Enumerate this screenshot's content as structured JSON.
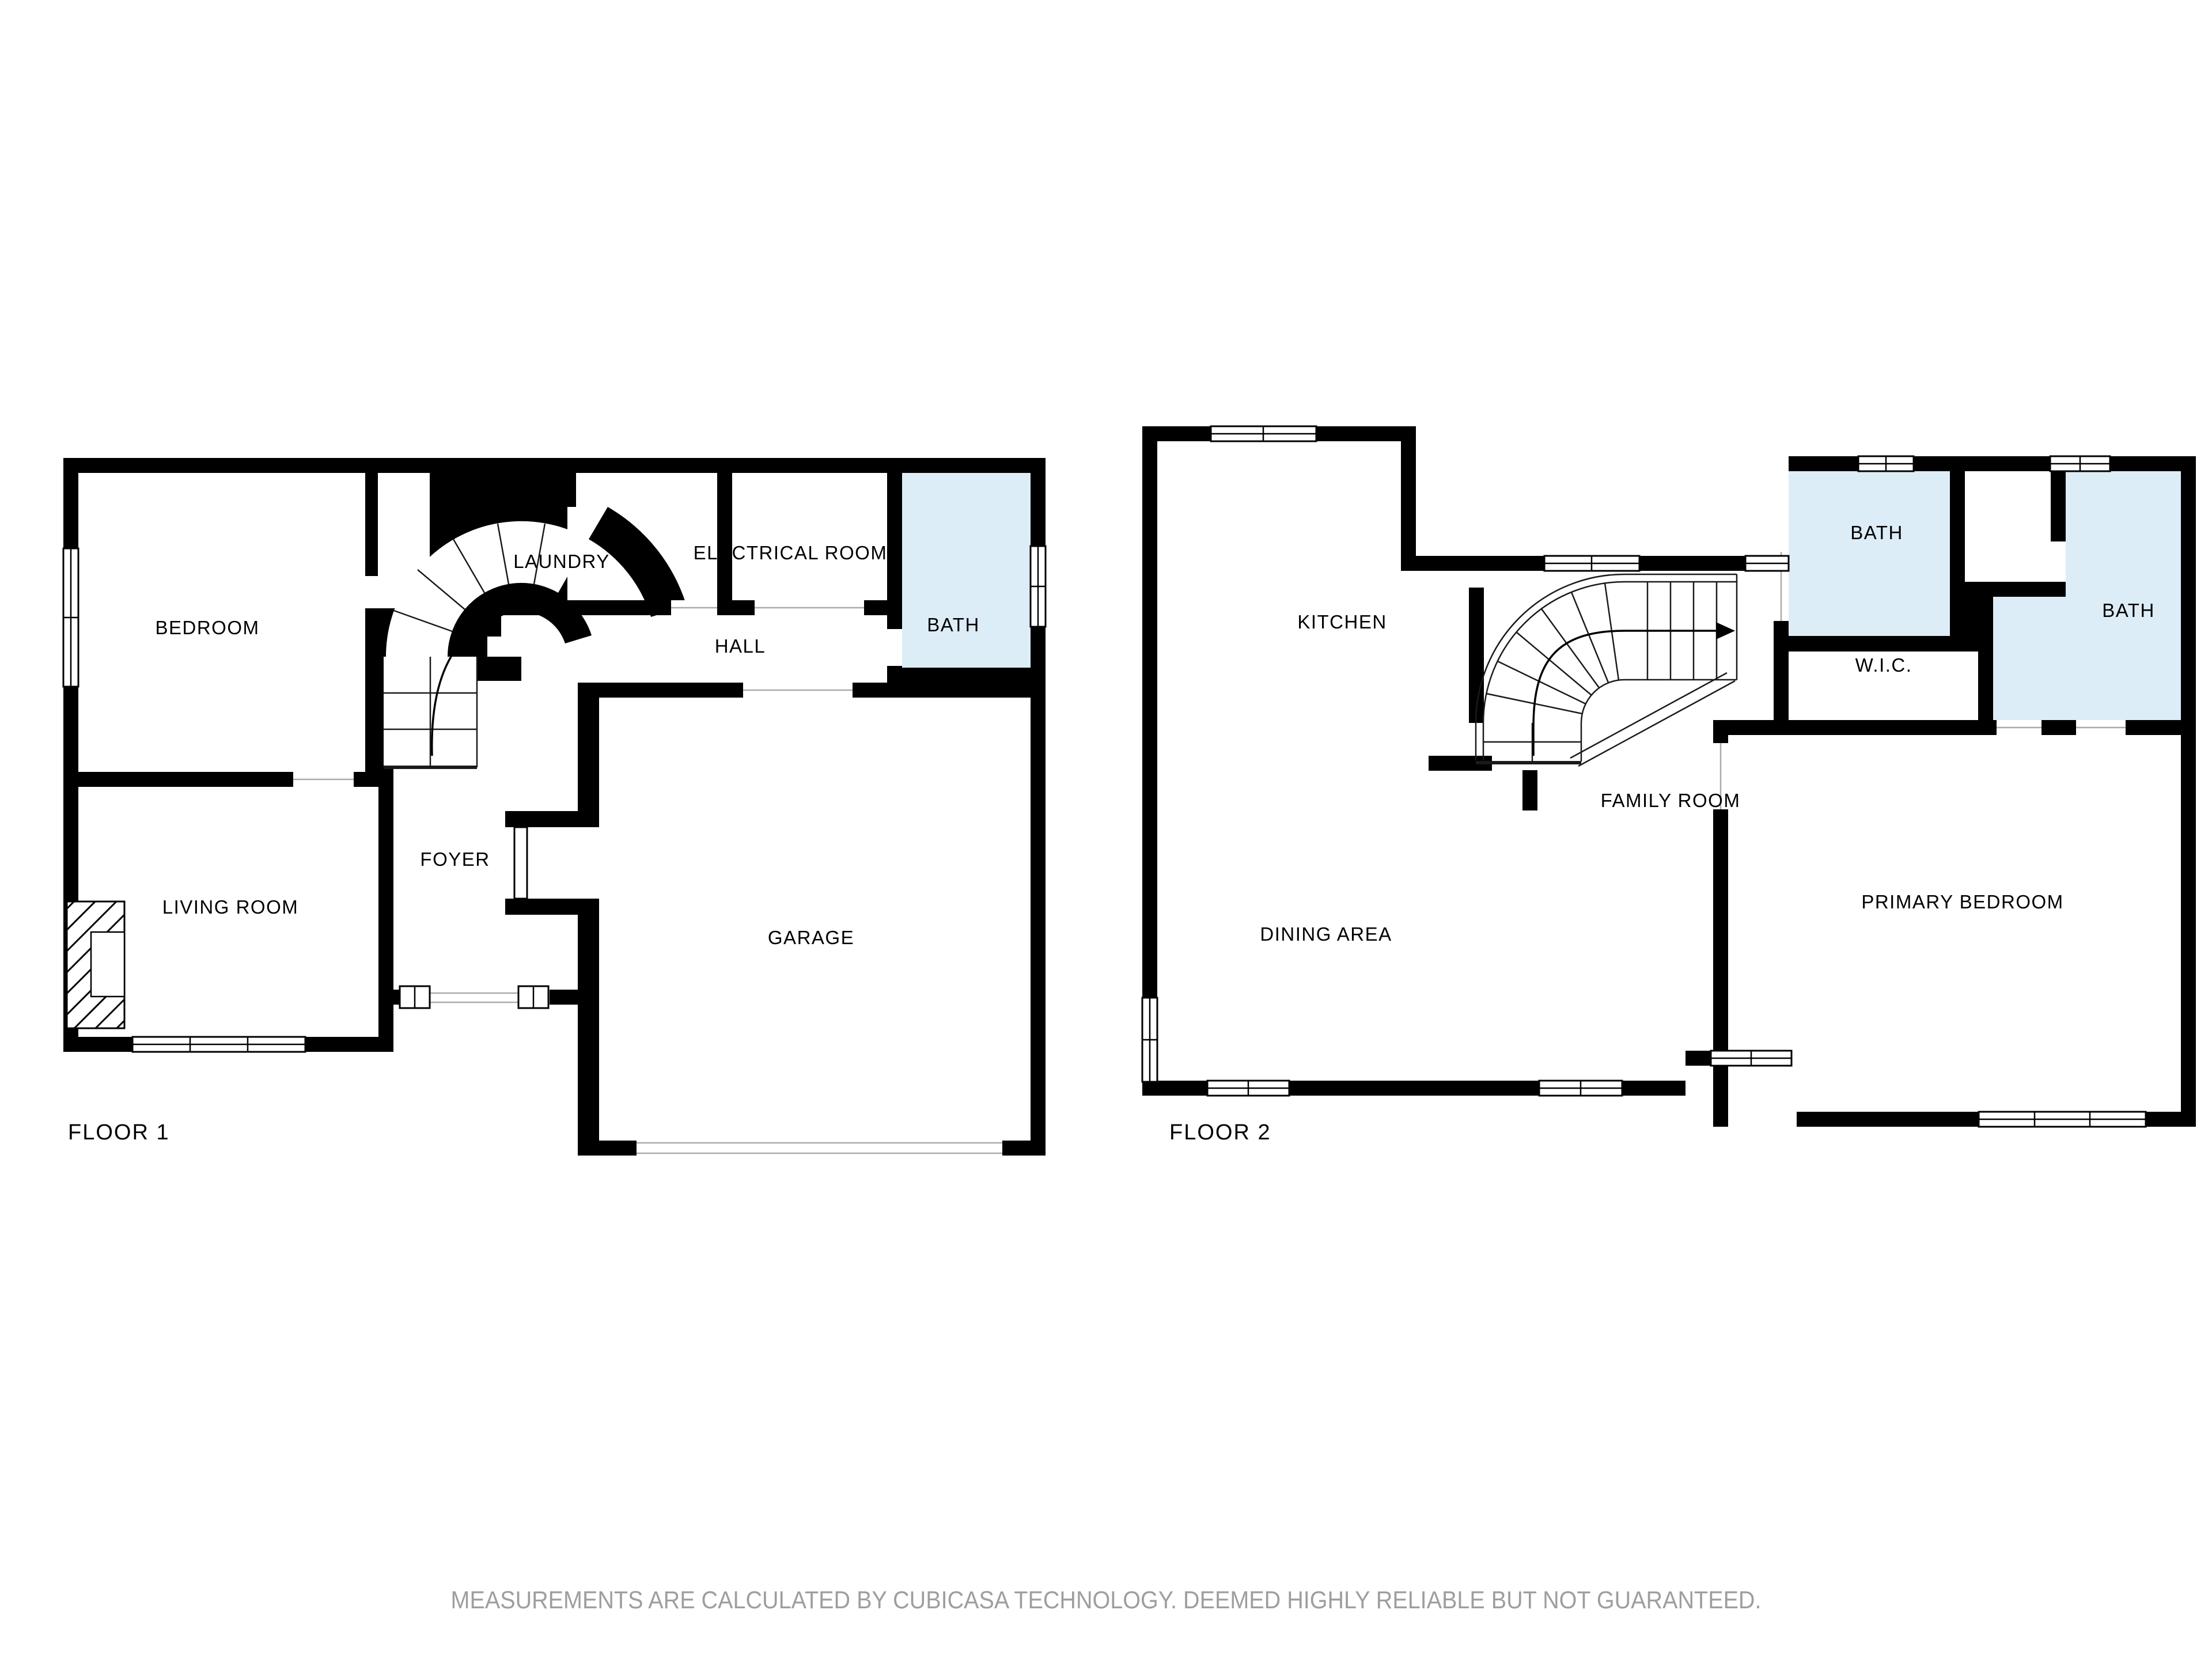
{
  "page": {
    "background": "#ffffff",
    "type": "floor-plan"
  },
  "floors": [
    {
      "id": "floor-1",
      "label": "FLOOR 1",
      "rooms": [
        {
          "id": "bedroom",
          "label": "BEDROOM"
        },
        {
          "id": "laundry",
          "label": "LAUNDRY"
        },
        {
          "id": "electrical-room",
          "label": "ELECTRICAL ROOM"
        },
        {
          "id": "bath",
          "label": "BATH"
        },
        {
          "id": "hall",
          "label": "HALL"
        },
        {
          "id": "foyer",
          "label": "FOYER"
        },
        {
          "id": "living-room",
          "label": "LIVING ROOM"
        },
        {
          "id": "garage",
          "label": "GARAGE"
        }
      ]
    },
    {
      "id": "floor-2",
      "label": "FLOOR 2",
      "rooms": [
        {
          "id": "kitchen",
          "label": "KITCHEN"
        },
        {
          "id": "bath-upper",
          "label": "BATH"
        },
        {
          "id": "bath-primary",
          "label": "BATH"
        },
        {
          "id": "wic",
          "label": "W.I.C."
        },
        {
          "id": "family-room",
          "label": "FAMILY ROOM"
        },
        {
          "id": "dining-area",
          "label": "DINING AREA"
        },
        {
          "id": "primary-bedroom",
          "label": "PRIMARY BEDROOM"
        }
      ]
    }
  ],
  "footer": {
    "text": "MEASUREMENTS ARE CALCULATED BY CUBICASA TECHNOLOGY. DEEMED HIGHLY RELIABLE BUT NOT GUARANTEED."
  },
  "colors": {
    "wall": "#000000",
    "room_fill": "#ffffff",
    "bath_fill": "#ddedf8",
    "opening_line": "#aaaaaa",
    "footer_text": "#9e9e9e",
    "label_text": "#000000"
  }
}
